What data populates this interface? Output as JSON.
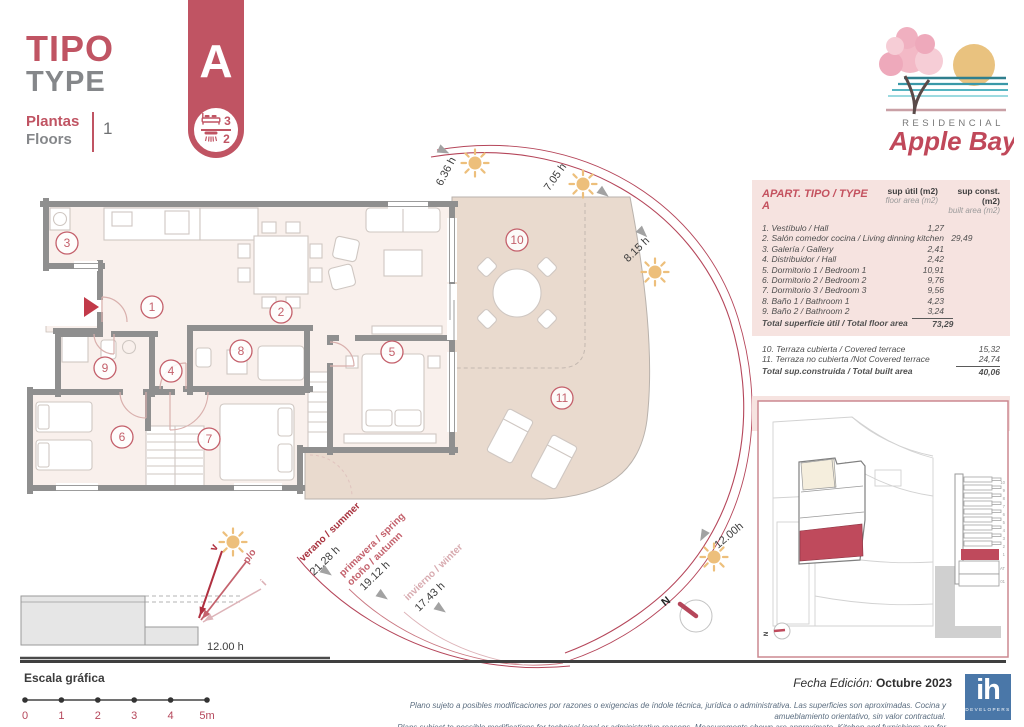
{
  "header": {
    "title_es": "TIPO",
    "title_en": "TYPE",
    "floors_label_es": "Plantas",
    "floors_label_en": "Floors",
    "floors_value": "1",
    "type_letter": "A",
    "bedrooms": "3",
    "bathrooms": "2"
  },
  "logo": {
    "line1": "RESIDENCIAL",
    "line2": "Apple Bay"
  },
  "table": {
    "title": "APART. TIPO / TYPE A",
    "col_util_1": "sup útil (m2)",
    "col_util_2": "floor area (m2)",
    "col_const_1": "sup const. (m2)",
    "col_const_2": "built area (m2)",
    "rows": [
      {
        "label": "1. Vestíbulo / Hall",
        "value": "1,27"
      },
      {
        "label": "2. Salón comedor cocina / Living dinning kitchen",
        "value": "29,49"
      },
      {
        "label": "3. Galería / Gallery",
        "value": "2,41"
      },
      {
        "label": "4. Distribuidor / Hall",
        "value": "2,42"
      },
      {
        "label": "5. Dormitorio 1 / Bedroom 1",
        "value": "10,91"
      },
      {
        "label": "6. Dormitorio 2 / Bedroom 2",
        "value": "9,76"
      },
      {
        "label": "7. Dormitorio 3 / Bedroom 3",
        "value": "9,56"
      },
      {
        "label": "8. Baño 1 / Bathroom 1",
        "value": "4,23"
      },
      {
        "label": "9. Baño 2 / Bathroom 2",
        "value": "3,24"
      }
    ],
    "total_util_label": "Total superficie útil / Total floor area",
    "total_util_value": "73,29",
    "terrace_rows": [
      {
        "label": "10. Terraza cubierta / Covered terrace",
        "value": "15,32"
      },
      {
        "label": "11. Terraza no cubierta /Not Covered terrace",
        "value": "24,74"
      }
    ],
    "total_built_label": "Total sup.construida / Total built area",
    "total_built_value": "40,06",
    "pp_label_es": "SUP. CONST. CON PP ZONAS COMUNES",
    "pp_label_en": "TOTAL BUILT AREA WITH PP COMMON AREAS",
    "pp_value": "166,64"
  },
  "plan": {
    "room_markers": [
      "1",
      "2",
      "3",
      "4",
      "5",
      "6",
      "7",
      "8",
      "9",
      "10",
      "11"
    ],
    "sun_times": [
      "6.36 h",
      "7.05 h",
      "8.15 h",
      "12.00h"
    ],
    "seasons": [
      {
        "line1": "verano / summer",
        "line2": "",
        "hours": "21.28 h"
      },
      {
        "line1": "primavera / spring",
        "line2": "otoño / autumn",
        "hours": "19.12 h"
      },
      {
        "line1": "invierno / winter",
        "line2": "",
        "hours": "17.43 h"
      }
    ],
    "section": {
      "v": "v",
      "po": "p/o",
      "i": "i",
      "noon": "12.00 h"
    },
    "compass_n": "N"
  },
  "siteplan": {
    "north": "N",
    "floor_labels": [
      "10",
      "9",
      "8",
      "7",
      "6",
      "5",
      "4",
      "3",
      "2",
      "1",
      "AT",
      "01"
    ]
  },
  "footer": {
    "scale_title": "Escala gráfica",
    "scale_ticks": [
      "0",
      "1",
      "2",
      "3",
      "4",
      "5m"
    ],
    "legal_es": "Plano sujeto a posibles modificaciones por razones o exigencias de índole técnica,  jurídica o administrativa. Las superficies son aproximadas. Cocina y amueblamiento orientativo, sin valor contractual.",
    "legal_en": "Plans subject to possible modifications for technical,legal or administrative reasons. Measurements shown are approximate. Kitchen and furnishings are for display purposes only, with no contractual value.",
    "edition_label": "Fecha Edición:",
    "edition_value": "Octubre 2023",
    "brand": "ih",
    "brand_sub": "DEVELOPERS"
  },
  "colors": {
    "accent": "#c05463",
    "accent_dark": "#a8323e",
    "table_red": "#c4525f",
    "terrace": "#e9dace",
    "interior": "#f9f0ec",
    "wall": "#8f8f8f",
    "sun": "#edbf7b",
    "brand_blue": "#4a77a8",
    "site_red": "#bf4a5c"
  }
}
